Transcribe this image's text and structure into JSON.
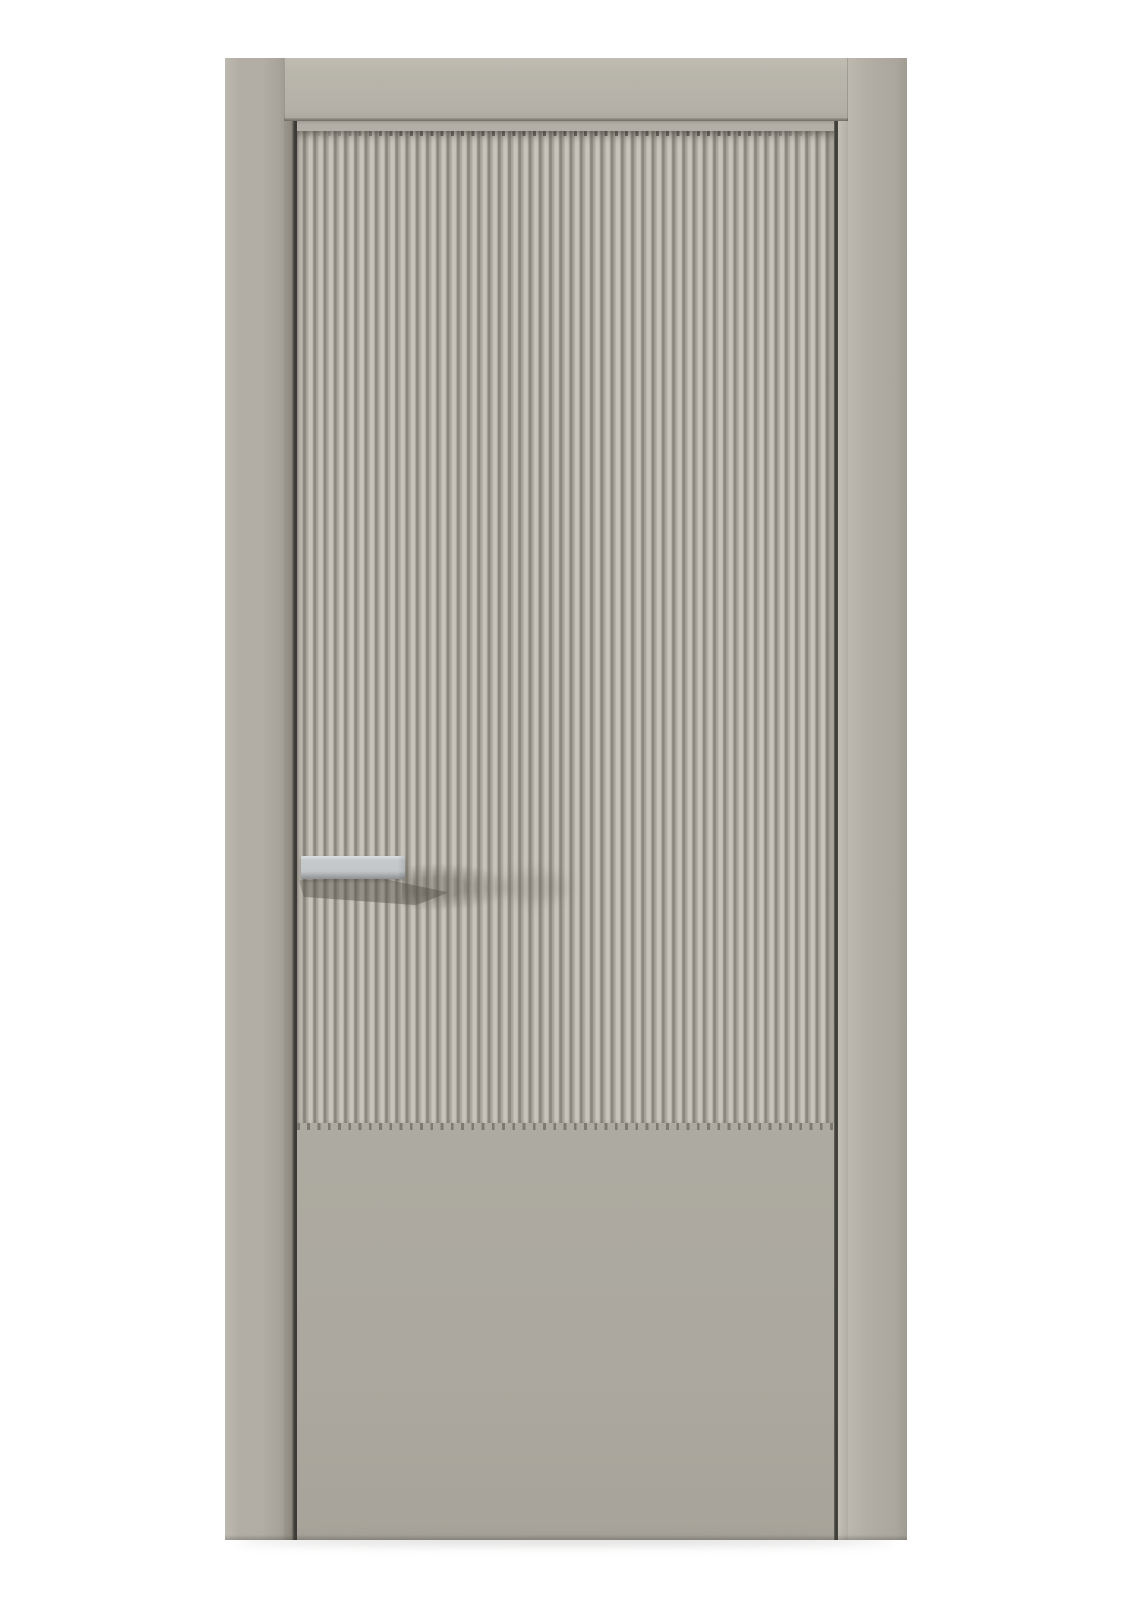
{
  "meta": {
    "type": "product-photo",
    "subject": "Closed interior door, front view, on white background"
  },
  "canvas": {
    "width": 1131,
    "height": 1600
  },
  "door": {
    "label": "Closed interior door with vertical fluted front panel",
    "frame": {
      "label": "Door frame: left jamb, header board, right jamb"
    },
    "leaf": {
      "label": "Door leaf"
    },
    "fluted_panel": {
      "label": "Vertical fluted (reeded) panel covering upper three quarters of leaf",
      "rib_count": 52,
      "rib_pitch_px": 10.25
    },
    "lower_panel": {
      "label": "Flat smooth lower panel"
    },
    "handle": {
      "label": "Horizontal rectangular bar handle, satin metal finish",
      "side": "left",
      "finish_color": "#c6c9cb"
    }
  },
  "colors": {
    "bg": "#ffffff",
    "jamb": "#b2aea5",
    "jamb-light": "#bdb9b0",
    "jamb-dark": "#a09c93",
    "header": "#b9b6ac",
    "header-shadow": "#6f6c64",
    "leaf": "#adaaa1",
    "rail": "#b3afa6",
    "rib-hi": "#c8c4bb",
    "rib-face": "#b5b1a8",
    "rib-dark": "#8b877e",
    "rib-floor": "#a9a59c",
    "gap-dark": "#3b3935",
    "reveal": "#8f8b82",
    "edge-hi": "#c4c0b7",
    "handle": "#c6c9cb",
    "handle-hi": "#dcdedf",
    "handle-dark": "#8e9193",
    "shadow": "#5a5750"
  }
}
